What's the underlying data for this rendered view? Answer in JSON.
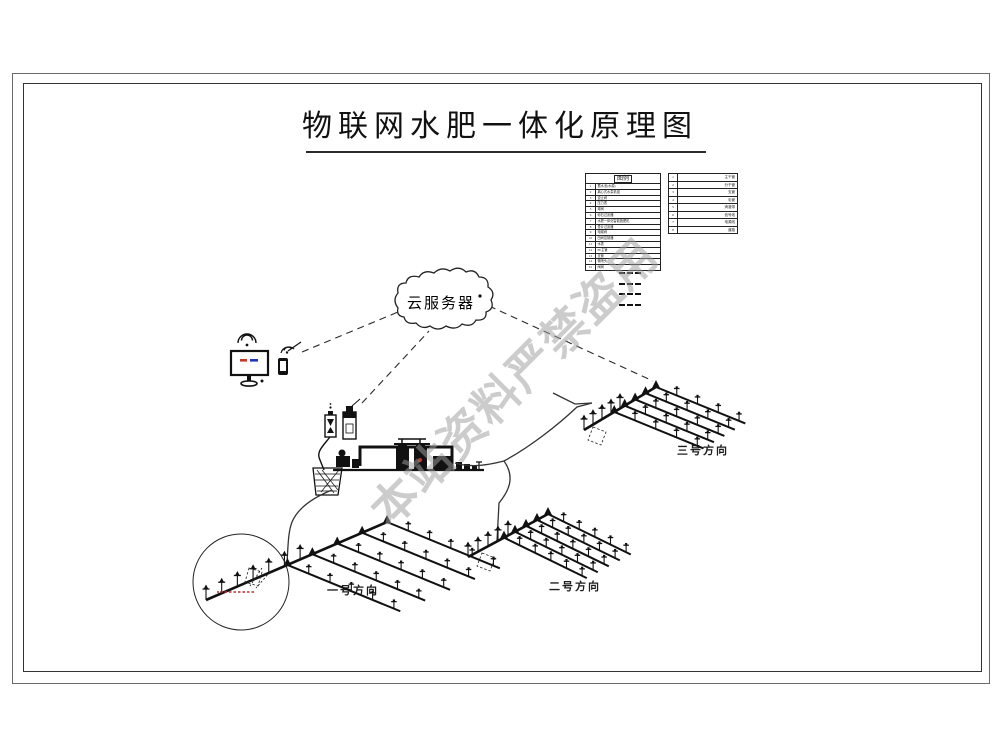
{
  "title": "物联网水肥一体化原理图",
  "watermark": "本站资料严禁盗用",
  "cloud_label": "云服务器",
  "legend": {
    "header": "图例",
    "main_rows": [
      {
        "no": "1",
        "label": "蓄水池(水源)"
      },
      {
        "no": "2",
        "label": "离心式水泵机组"
      },
      {
        "no": "3",
        "label": "逆止阀"
      },
      {
        "no": "4",
        "label": "压力表"
      },
      {
        "no": "5",
        "label": "球阀"
      },
      {
        "no": "6",
        "label": "砂石过滤器"
      },
      {
        "no": "7",
        "label": "水肥一体化智能施肥机"
      },
      {
        "no": "8",
        "label": "叠片过滤器"
      },
      {
        "no": "9",
        "label": "电磁阀"
      },
      {
        "no": "10",
        "label": "田间控制器"
      },
      {
        "no": "11",
        "label": "水表"
      },
      {
        "no": "12",
        "label": "PE主管"
      },
      {
        "no": "13",
        "label": "支管"
      },
      {
        "no": "14",
        "label": "微喷头"
      },
      {
        "no": "15",
        "label": "闸阀"
      }
    ],
    "line_rows": [
      {
        "no": "1",
        "label": "主干管"
      },
      {
        "no": "2",
        "label": "分干管"
      },
      {
        "no": "3",
        "label": "支管"
      },
      {
        "no": "4",
        "label": "毛管"
      },
      {
        "no": "5",
        "label": "滴灌带"
      },
      {
        "no": "6",
        "label": "信号线"
      },
      {
        "no": "7",
        "label": "电源线"
      },
      {
        "no": "8",
        "label": "道路"
      }
    ]
  },
  "fields": [
    {
      "label": "一号方向"
    },
    {
      "label": "二号方向"
    },
    {
      "label": "三号方向"
    }
  ],
  "icons": {
    "cloud": "cloud-shape",
    "wifi": "wifi-icon",
    "monitor": "monitor-icon",
    "smartphone": "smartphone-icon"
  },
  "colors": {
    "ink": "#1a1a1a",
    "watermark_gray": "#9e9e9e",
    "screen_red": "#c0392b",
    "screen_blue": "#2233bb",
    "dot_red": "#c0392b"
  }
}
